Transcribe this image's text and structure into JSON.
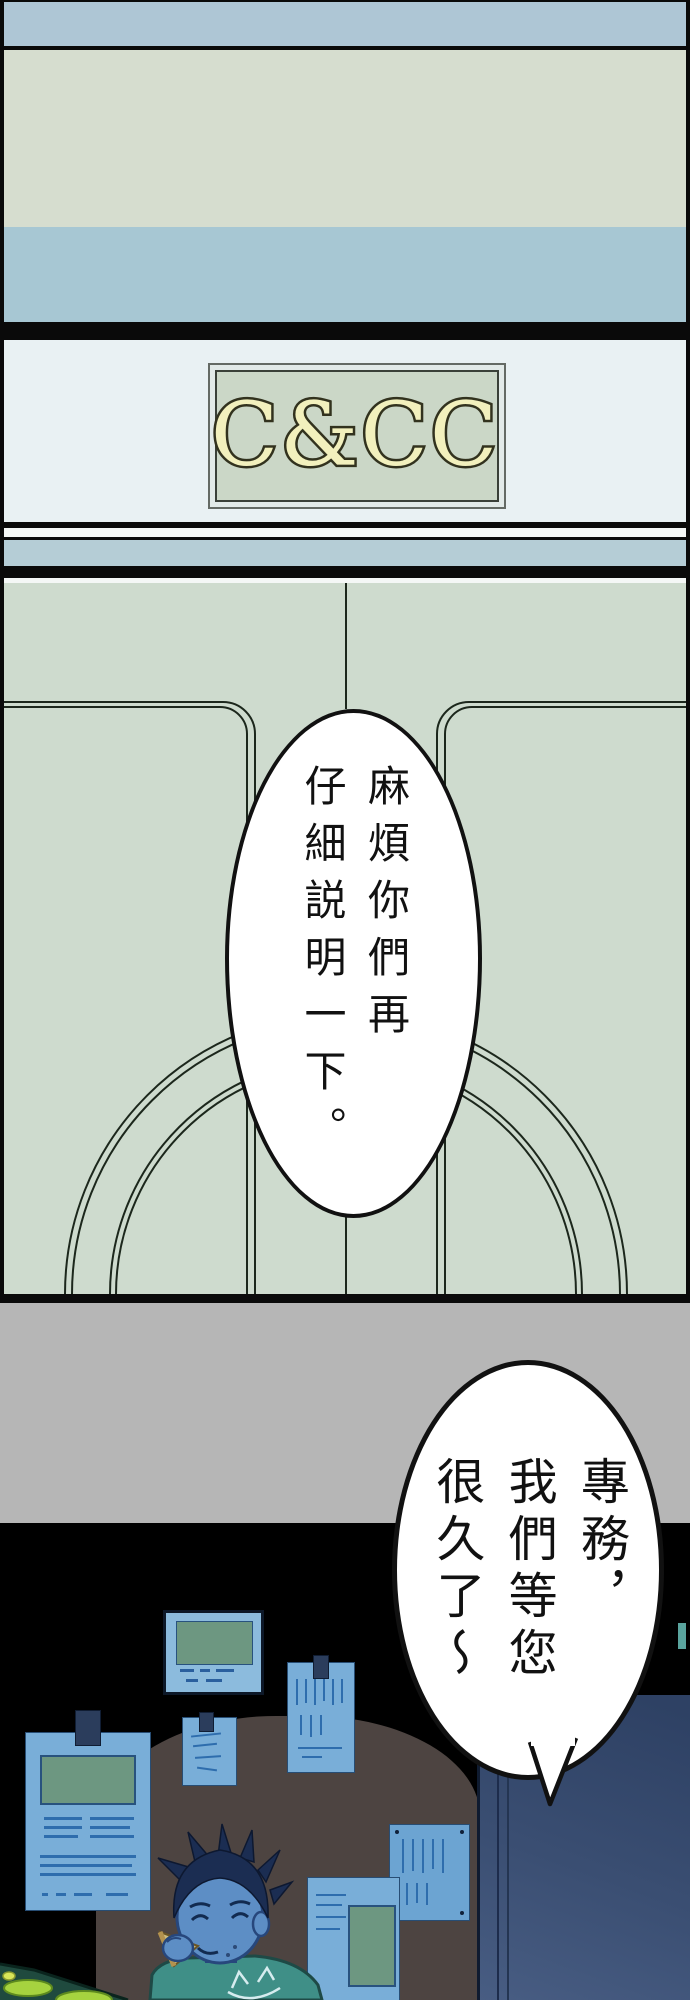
{
  "sign": {
    "text": "C&CC"
  },
  "bubbles": {
    "door": {
      "cols": [
        "麻煩你們再",
        "仔細説明一下。"
      ]
    },
    "office": {
      "cols": [
        "專務，",
        "我們等您",
        "很久了～"
      ]
    }
  },
  "colors": {
    "band_top_blue": "#aec6d5",
    "band_pale_green": "#d6ddcf",
    "band_mid_blue": "#a7c7d3",
    "divider_blue": "#b5cdd6",
    "sign_panel_bg": "#e9f1f3",
    "sign_bg": "#cbd7c7",
    "sign_letters": "#f2f0bd",
    "door_panel_green": "#cedbce",
    "panel_line": "#1c271c",
    "concrete_gray": "#b6b6b6",
    "scene_black": "#000000",
    "wall_brown": "#4d4441",
    "office_door_navy": "#2f4266",
    "poster_blue": "#79aed8",
    "poster_ink": "#2e6dad",
    "photo_green": "#6d9781",
    "skin_blue": "#5d8ec5",
    "hair_navy": "#1b2d52",
    "shirt_teal": "#3f8f87",
    "pizza_tan": "#cfbd7e",
    "desk_teal": "#1f4a3e",
    "plate_lime": "#a6d33f",
    "bubble_bg": "#ffffff",
    "bubble_outline": "#111111"
  }
}
